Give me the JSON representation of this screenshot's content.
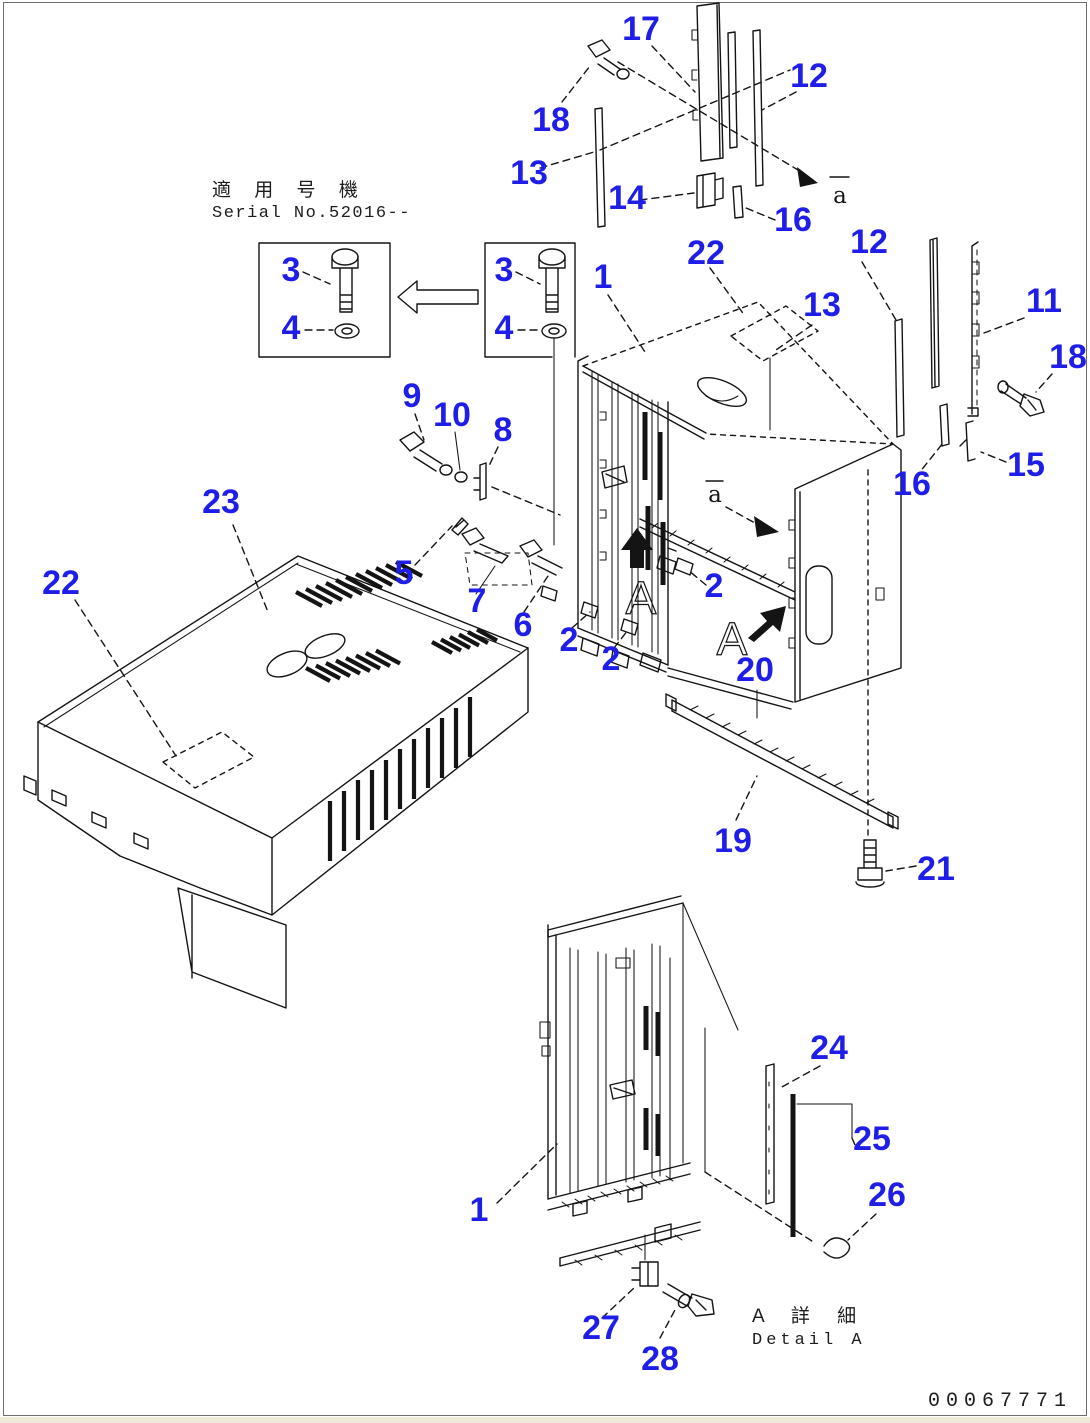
{
  "header": {
    "applicability_jp": "適 用 号 機",
    "applicability_serial": "Serial No.52016--"
  },
  "footer": {
    "detail_label_jp": "A 詳 細",
    "detail_label_en": "Detail A",
    "drawing_number": "00067771"
  },
  "colors": {
    "callout_blue": "#1e1ee8",
    "line_black": "#141414",
    "paper": "#ffffff"
  },
  "callouts": [
    {
      "part": "17",
      "x": 641,
      "y": 40
    },
    {
      "part": "18",
      "x": 551,
      "y": 131
    },
    {
      "part": "12",
      "x": 809,
      "y": 87
    },
    {
      "part": "13",
      "x": 529,
      "y": 184
    },
    {
      "part": "14",
      "x": 627,
      "y": 209
    },
    {
      "part": "16",
      "x": 793,
      "y": 231
    },
    {
      "part": "22",
      "x": 706,
      "y": 264
    },
    {
      "part": "12",
      "x": 869,
      "y": 253
    },
    {
      "part": "13",
      "x": 822,
      "y": 316
    },
    {
      "part": "11",
      "x": 1044,
      "y": 312
    },
    {
      "part": "18",
      "x": 1068,
      "y": 368
    },
    {
      "part": "1",
      "x": 603,
      "y": 288
    },
    {
      "part": "3",
      "x": 291,
      "y": 281
    },
    {
      "part": "4",
      "x": 291,
      "y": 339
    },
    {
      "part": "3",
      "x": 504,
      "y": 281
    },
    {
      "part": "4",
      "x": 504,
      "y": 339
    },
    {
      "part": "9",
      "x": 412,
      "y": 407
    },
    {
      "part": "10",
      "x": 452,
      "y": 426
    },
    {
      "part": "8",
      "x": 503,
      "y": 441
    },
    {
      "part": "23",
      "x": 221,
      "y": 513
    },
    {
      "part": "22",
      "x": 61,
      "y": 594
    },
    {
      "part": "5",
      "x": 404,
      "y": 584
    },
    {
      "part": "7",
      "x": 477,
      "y": 612
    },
    {
      "part": "6",
      "x": 523,
      "y": 636
    },
    {
      "part": "2",
      "x": 569,
      "y": 651
    },
    {
      "part": "2",
      "x": 611,
      "y": 670
    },
    {
      "part": "2",
      "x": 714,
      "y": 597
    },
    {
      "part": "16",
      "x": 912,
      "y": 495
    },
    {
      "part": "15",
      "x": 1026,
      "y": 476
    },
    {
      "part": "20",
      "x": 755,
      "y": 681
    },
    {
      "part": "19",
      "x": 733,
      "y": 852
    },
    {
      "part": "21",
      "x": 936,
      "y": 880
    },
    {
      "part": "24",
      "x": 829,
      "y": 1059
    },
    {
      "part": "25",
      "x": 872,
      "y": 1150
    },
    {
      "part": "26",
      "x": 887,
      "y": 1206
    },
    {
      "part": "1",
      "x": 479,
      "y": 1221
    },
    {
      "part": "27",
      "x": 601,
      "y": 1339
    },
    {
      "part": "28",
      "x": 660,
      "y": 1370
    }
  ],
  "view_labels": [
    {
      "text": "a",
      "x": 840,
      "y": 203,
      "style": "view-dir"
    },
    {
      "text": "a",
      "x": 715,
      "y": 502,
      "style": "view-dir"
    },
    {
      "text": "A",
      "x": 641,
      "y": 614,
      "style": "detail-letter"
    },
    {
      "text": "A",
      "x": 732,
      "y": 655,
      "style": "detail-letter"
    }
  ]
}
